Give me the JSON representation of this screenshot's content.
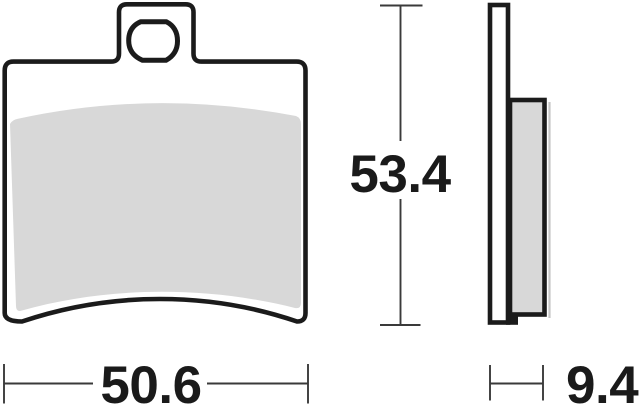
{
  "drawing": {
    "type": "technical-dimension-drawing",
    "subject": "brake-pad",
    "views": {
      "front": "brake-pad-front-view",
      "side": "brake-pad-side-profile"
    },
    "dimensions": {
      "width_label": "50.6",
      "height_label": "53.4",
      "thickness_label": "9.4"
    },
    "colors": {
      "outline": "#1b1b1b",
      "friction_material": "#d8d8d8",
      "dimension_line": "#3a3a3a",
      "background": "#ffffff"
    }
  }
}
